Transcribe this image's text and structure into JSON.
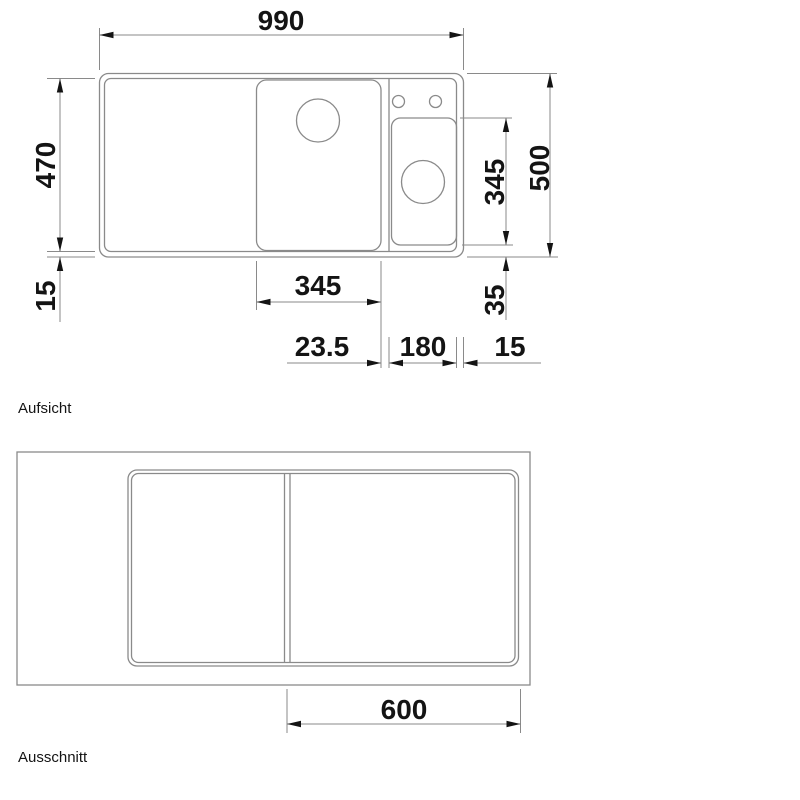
{
  "colors": {
    "background": "#ffffff",
    "line": "#8a8a8a",
    "ink": "#141414"
  },
  "views": {
    "top_view": {
      "label": "Aufsicht",
      "dims": {
        "overall_width": "990",
        "rim_depth": "470",
        "rim_front_border": "15",
        "small_bowl_depth": "345",
        "overall_depth": "500",
        "small_bowl_front_offset": "35",
        "main_bowl_width": "345",
        "bowl_spacing": "23.5",
        "small_bowl_width": "180",
        "rim_right_border": "15"
      }
    },
    "cutout_view": {
      "label": "Ausschnitt",
      "dims": {
        "cut_segment_width": "600"
      }
    }
  }
}
